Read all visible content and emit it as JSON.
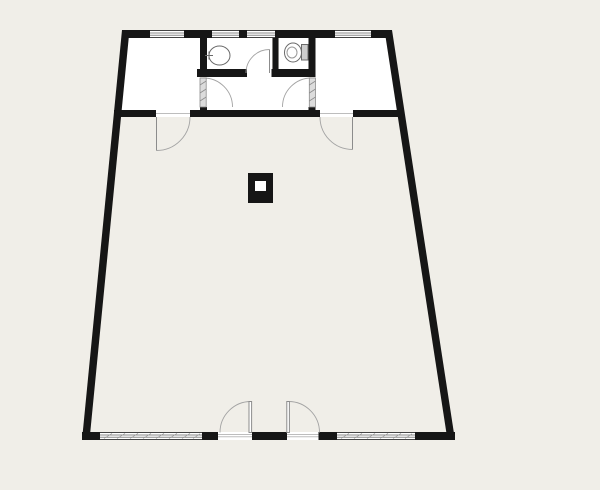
{
  "drawing": {
    "kind": "architectural floor plan, top view, no text labels"
  },
  "colors": {
    "background": "#f0eee8",
    "room_fill": "#ffffff",
    "wall": "#161616",
    "door_line": "#a3a3a3",
    "leaf_line": "#8c8c8c",
    "window_line": "#8a8a8a",
    "threshold_line": "#bdbdbd",
    "hatch_line": "#9b9b9b",
    "fixture_stroke": "#6a6a6a",
    "fixture_inner": "#999999",
    "tank_fill": "#cdcdcd",
    "strip_fill": "#dcdcdc",
    "column_hole": "#ffffff"
  },
  "icons": {
    "toilet": "toilet-top-view-icon",
    "sink": "washbasin-top-view-icon",
    "column": "structural-column-icon"
  }
}
